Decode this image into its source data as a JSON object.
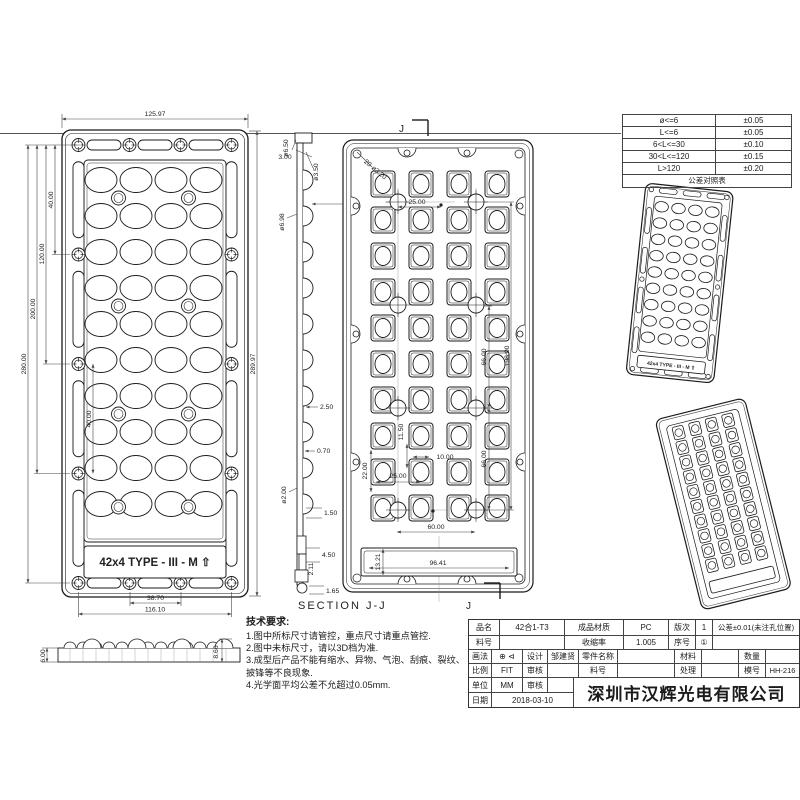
{
  "drawing": {
    "front": {
      "dim_width": "125.97",
      "dim_h1": "280.00",
      "dim_h2": "200.00",
      "dim_h3": "120.00",
      "dim_h4": "40.00",
      "dim_h5": "40.00",
      "dim_height_overall": "289.97",
      "dim_b1": "38.70",
      "dim_b2": "116.10",
      "label": "42x4 TYPE - III - M ⇧"
    },
    "side": {
      "d_top": "ø6.50",
      "t1": "3.00",
      "d_mid": "ø3.50",
      "t2": "3.00",
      "d_low": "ø6.98",
      "t3": "2.50",
      "t4": "0.70",
      "d_bot": "ø2.00",
      "t5": "1.50",
      "t6": "4.50",
      "t7": "2.11",
      "t8": "1.65"
    },
    "section": {
      "title": "SECTION J-J",
      "j_mark": "J",
      "hole_callout": "20-ø3.20",
      "d1": "25.00",
      "d2": "66.00",
      "d3": "66.00",
      "d4": "198.00",
      "d5": "11.50",
      "d6": "10.00",
      "d7": "25.00",
      "d8": "22.00",
      "d9": "60.00",
      "d10": "96.41",
      "d11": "13.21"
    },
    "flat": {
      "left": "6.00",
      "right": "8.60"
    },
    "iso_label": "42x4 TYPE - III - M ⇧"
  },
  "tolerance_table": {
    "rows": [
      [
        "ø<=6",
        "±0.05"
      ],
      [
        "L<=6",
        "±0.05"
      ],
      [
        "6<L<=30",
        "±0.10"
      ],
      [
        "30<L<=120",
        "±0.15"
      ],
      [
        "L>120",
        "±0.20"
      ]
    ],
    "footer": "公差对照表"
  },
  "notes": {
    "title": "技术要求:",
    "items": [
      "1.图中所标尺寸请管控，重点尺寸请重点管控.",
      "2.图中未标尺寸，请以3D档为准.",
      "3.成型后产品不能有缩水、异物、气泡、刮痕、裂纹、披锋等不良现象.",
      "4.光学面平均公差不允超过0.05mm."
    ]
  },
  "title_block": {
    "part_name_label": "品名",
    "part_name": "42合1-T3",
    "material_label": "成品材质",
    "material": "PC",
    "rev_label": "版次",
    "rev": "1",
    "tolerance_note": "公差±0.01(未注孔位置)",
    "part_no_label": "料号",
    "part_no": "",
    "shrinkage_label": "收缩率",
    "shrinkage": "1.005",
    "seq_label": "序号",
    "seq": "①",
    "projection_label": "画法",
    "projection_symbol": "⊕ ⊲",
    "design_label": "设计",
    "designer": "邹建贤",
    "component_name_label": "零件名称",
    "component_name": "",
    "material2_label": "材料",
    "material2": "",
    "qty_label": "数量",
    "qty": "",
    "scale_label": "比例",
    "scale": "FIT",
    "check_label": "审核",
    "check": "",
    "part_no2_label": "料号",
    "part_no2": "",
    "treatment_label": "处理",
    "treatment": "",
    "mold_label": "模号",
    "mold_no": "HH-216",
    "unit_label": "单位",
    "unit": "MM",
    "check2_label": "审核",
    "check2": "",
    "date_label": "日期",
    "date": "2018-03-10",
    "company": "深圳市汉辉光电有限公司"
  }
}
